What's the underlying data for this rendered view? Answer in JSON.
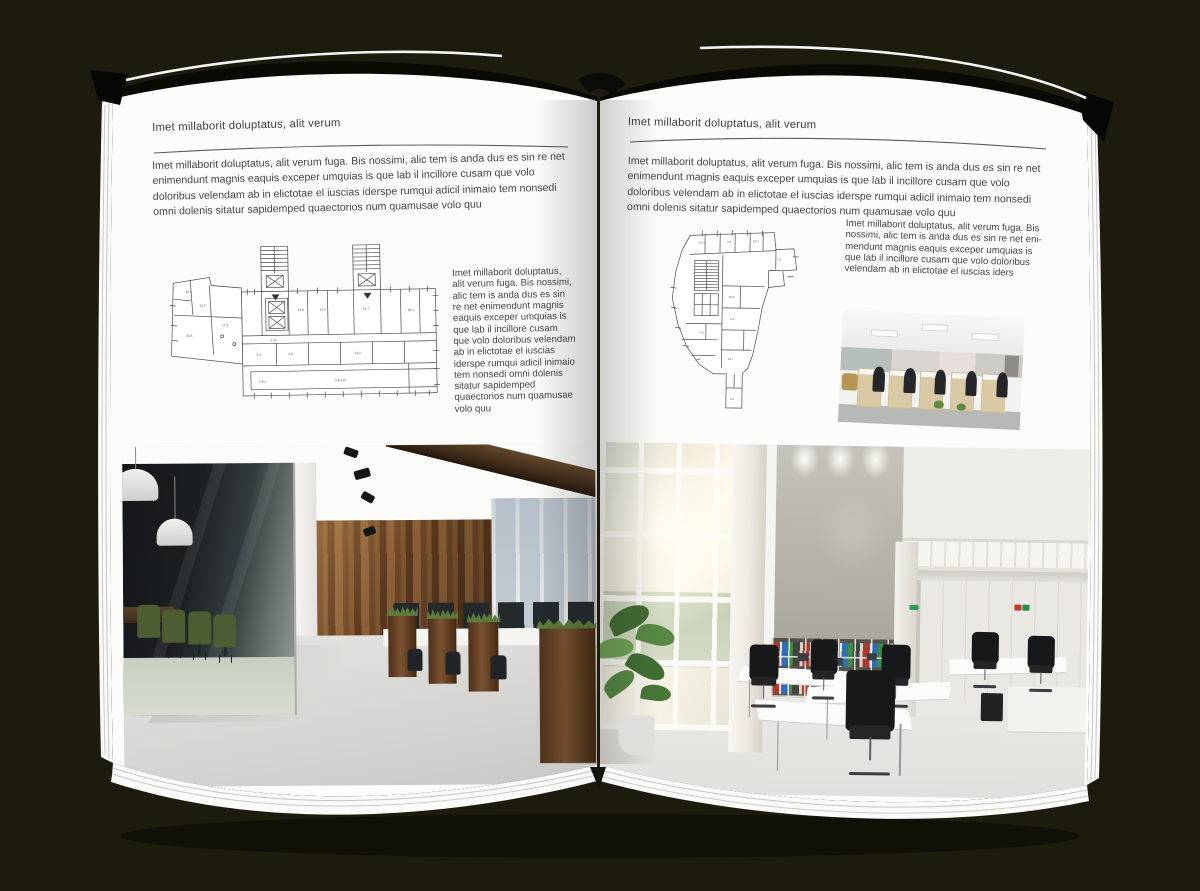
{
  "canvas": {
    "background_color": "#1c1b0c",
    "page_color": "#fcfcfa",
    "text_color": "#3f3f3f"
  },
  "left_page": {
    "header": "Imet millaborit doluptatus, alit verum",
    "intro": "Imet millaborit doluptatus, alit verum fuga. Bis nossimi, alic tem is anda dus es sin re net enimendunt magnis eaquis exceper umquias is que lab il incillore cusam que volo doloribus velendam ab in elictotae el iuscias iderspe rumqui adicil inimaio tem nonsedi omni dolenis sitatur sapidemped quaectorios num quamusae volo quu",
    "caption": "Imet millaborit doluptatus, alit verum fuga. Bis nossimi, alic tem is anda dus es sin re net enimendunt magnis eaquis exceper umquias is que lab il incillore cusam que volo doloribus velendam ab in elictotae el iuscias iderspe rumqui adicil inimaio tem nonsedi omni dolenis sitatur sapidemped quaectorios num quamusae volo quu",
    "floorplan": {
      "alt": "architectural floor plan: rectangular block with two stair towers and angled west wing"
    },
    "photo": {
      "alt": "office interior with dark glass meeting room, green chairs and wooden accent wall"
    }
  },
  "right_page": {
    "header": "Imet millaborit doluptatus, alit verum",
    "intro": "Imet millaborit doluptatus, alit verum fuga. Bis nossimi, alic tem is anda dus es sin re net enimendunt magnis eaquis exceper umquias is que lab il incillore cusam que volo doloribus velendam ab in elictotae el iuscias iderspe rumqui adicil inimaio tem nonsedi omni dolenis sitatur sapidemped quaectorios num quamusae volo quu",
    "caption": "Imet millaborit doluptatus, alit verum fuga. Bis nossimi, alic tem is anda dus es sin re net eni-mendunt magnis eaquis exceper umquias is que lab il incillore cusam que volo doloribus velendam ab in elictotae el iuscias iders",
    "floorplan": {
      "alt": "architectural floor plan: irregular wedge-shaped building with curved west facade"
    },
    "photo_small": {
      "alt": "open-plan office with beige workstation cabinets and black chairs"
    },
    "photo_large": {
      "alt": "bright double-height office with window wall, concrete feature wall, binder shelves and white desks"
    }
  }
}
